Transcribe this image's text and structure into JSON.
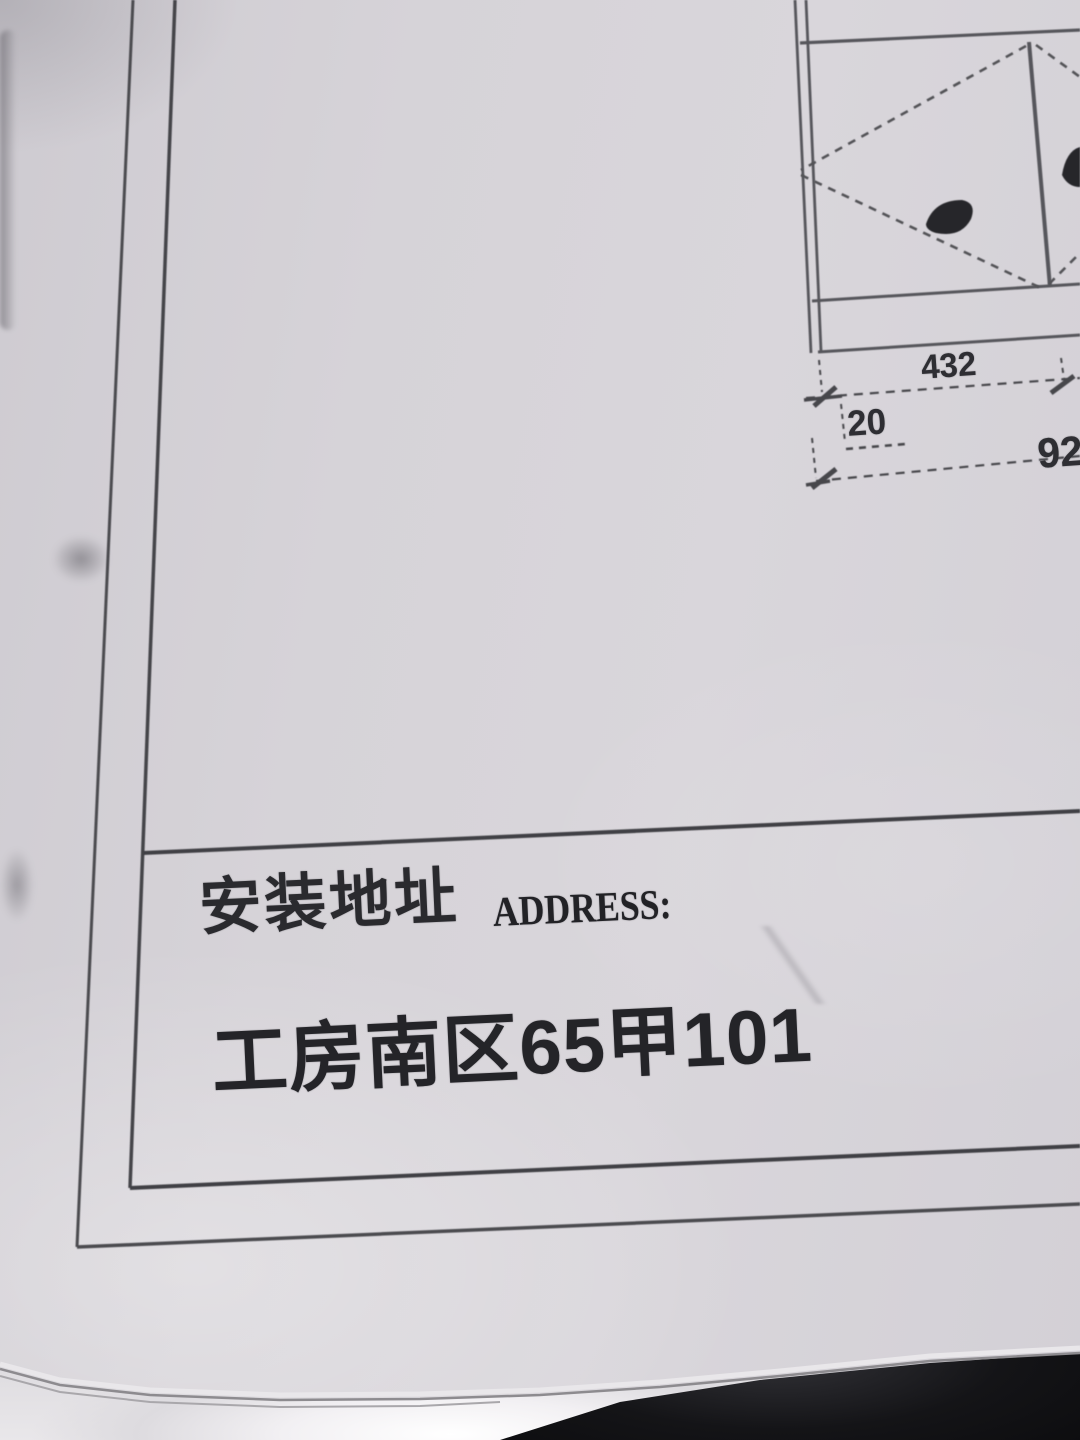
{
  "title_block": {
    "label_cn": "安装地址",
    "label_en": "ADDRESS:",
    "address": "工房南区65甲101"
  },
  "drawing": {
    "dim_width": "432",
    "dim_gap": "20",
    "dim_partial": "92"
  },
  "colors": {
    "paper": "#d6d3d8",
    "border_line": "#47474c",
    "drawing_line": "#56565b",
    "ink": "#232327",
    "floor_dark": "#0e0e10",
    "floor_light": "#f4f2f5"
  }
}
